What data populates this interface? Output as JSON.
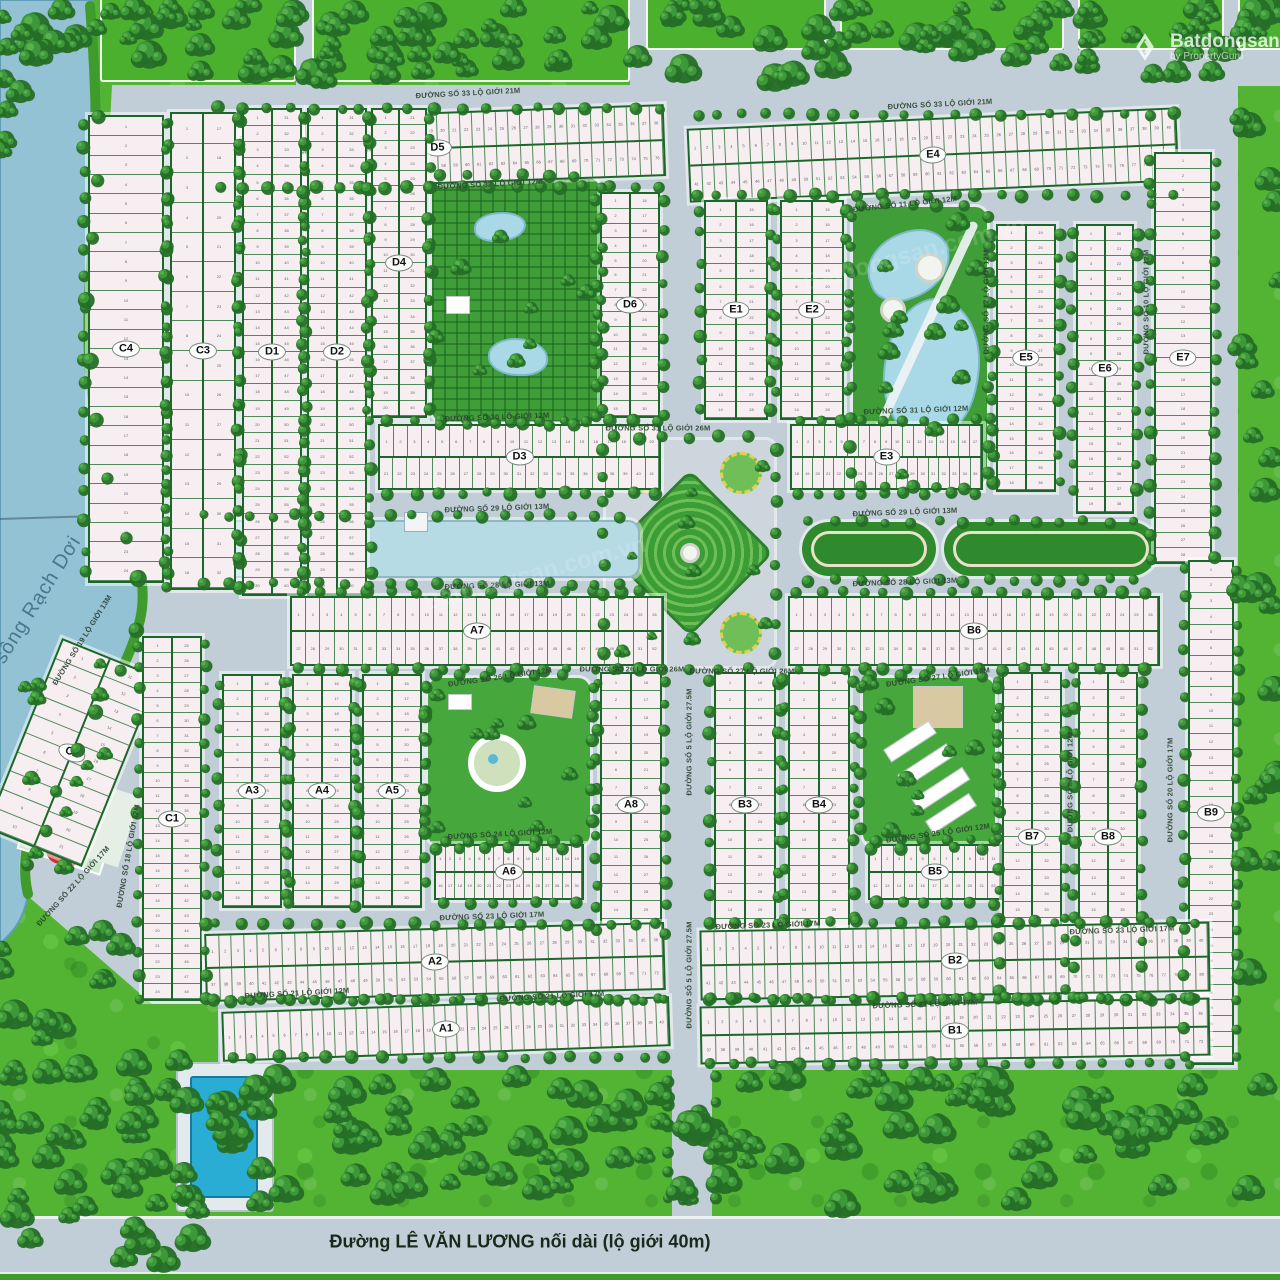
{
  "watermark": {
    "brand": "Batdongsan",
    "byline": "by PropertyGuru"
  },
  "diagonal_watermark": "Batdongsan.com.vn",
  "river": {
    "name": "sông Rạch Dơi"
  },
  "main_road": {
    "name": "Đường LÊ VĂN LƯƠNG nối dài (lộ giới 40m)"
  },
  "colors": {
    "road": "#c2ced7",
    "lot_fill": "#f7eef1",
    "block_border": "#1b672a",
    "grass": "#53b434",
    "tree": "#2c7e2e",
    "river_water": "#93c2d4",
    "pond": "#a9d9e6",
    "pool": "#29add5"
  },
  "blocks": [
    {
      "label": "D5",
      "x": 210,
      "y": 112,
      "w": 455,
      "h": 72,
      "dir": "h",
      "rows": [
        38,
        38
      ],
      "rot": -2
    },
    {
      "label": "C4",
      "x": 88,
      "y": 115,
      "w": 76,
      "h": 468,
      "dir": "v",
      "rows": [
        24
      ]
    },
    {
      "label": "C3",
      "x": 170,
      "y": 112,
      "w": 66,
      "h": 478,
      "dir": "v",
      "rows": [
        16,
        16
      ]
    },
    {
      "label": "D1",
      "x": 242,
      "y": 108,
      "w": 60,
      "h": 488,
      "dir": "v",
      "rows": [
        30,
        30
      ]
    },
    {
      "label": "D2",
      "x": 307,
      "y": 108,
      "w": 60,
      "h": 488,
      "dir": "v",
      "rows": [
        30,
        30
      ]
    },
    {
      "label": "D4",
      "x": 371,
      "y": 108,
      "w": 56,
      "h": 310,
      "dir": "v",
      "rows": [
        20,
        20
      ]
    },
    {
      "label": "D6",
      "x": 600,
      "y": 192,
      "w": 60,
      "h": 226,
      "dir": "v",
      "rows": [
        15,
        15
      ]
    },
    {
      "label": "D3",
      "x": 378,
      "y": 424,
      "w": 283,
      "h": 66,
      "dir": "h",
      "rows": [
        20,
        21
      ]
    },
    {
      "label": "E4",
      "x": 688,
      "y": 118,
      "w": 490,
      "h": 74,
      "dir": "h",
      "rows": [
        40,
        40
      ],
      "rot": -2.5
    },
    {
      "label": "E1",
      "x": 704,
      "y": 200,
      "w": 64,
      "h": 220,
      "dir": "v",
      "rows": [
        14,
        14
      ]
    },
    {
      "label": "E2",
      "x": 780,
      "y": 200,
      "w": 64,
      "h": 220,
      "dir": "v",
      "rows": [
        14,
        14
      ]
    },
    {
      "label": "E3",
      "x": 790,
      "y": 424,
      "w": 193,
      "h": 66,
      "dir": "h",
      "rows": [
        17,
        18
      ]
    },
    {
      "label": "E5",
      "x": 996,
      "y": 224,
      "w": 60,
      "h": 268,
      "dir": "v",
      "rows": [
        18,
        18
      ]
    },
    {
      "label": "E6",
      "x": 1076,
      "y": 224,
      "w": 58,
      "h": 290,
      "dir": "v",
      "rows": [
        19,
        19
      ]
    },
    {
      "label": "E7",
      "x": 1154,
      "y": 152,
      "w": 58,
      "h": 412,
      "dir": "v",
      "rows": [
        28
      ]
    },
    {
      "label": "A7",
      "x": 290,
      "y": 596,
      "w": 374,
      "h": 70,
      "dir": "h",
      "rows": [
        26,
        26
      ]
    },
    {
      "label": "B6",
      "x": 788,
      "y": 596,
      "w": 372,
      "h": 70,
      "dir": "h",
      "rows": [
        26,
        26
      ]
    },
    {
      "label": "C2",
      "x": 20,
      "y": 650,
      "w": 104,
      "h": 205,
      "dir": "v",
      "rows": [
        10,
        11
      ],
      "rot": 22
    },
    {
      "label": "C1",
      "x": 142,
      "y": 636,
      "w": 60,
      "h": 365,
      "dir": "v",
      "rows": [
        24,
        24
      ]
    },
    {
      "label": "A3",
      "x": 222,
      "y": 674,
      "w": 60,
      "h": 234,
      "dir": "v",
      "rows": [
        15,
        15
      ]
    },
    {
      "label": "A4",
      "x": 292,
      "y": 674,
      "w": 60,
      "h": 234,
      "dir": "v",
      "rows": [
        15,
        15
      ]
    },
    {
      "label": "A5",
      "x": 362,
      "y": 674,
      "w": 60,
      "h": 234,
      "dir": "v",
      "rows": [
        15,
        15
      ]
    },
    {
      "label": "A8",
      "x": 600,
      "y": 672,
      "w": 62,
      "h": 266,
      "dir": "v",
      "rows": [
        15,
        15
      ]
    },
    {
      "label": "A6",
      "x": 434,
      "y": 844,
      "w": 150,
      "h": 56,
      "dir": "h",
      "rows": [
        15,
        15
      ]
    },
    {
      "label": "B3",
      "x": 714,
      "y": 672,
      "w": 62,
      "h": 266,
      "dir": "v",
      "rows": [
        15,
        15
      ]
    },
    {
      "label": "B4",
      "x": 788,
      "y": 672,
      "w": 62,
      "h": 266,
      "dir": "v",
      "rows": [
        15,
        15
      ]
    },
    {
      "label": "B5",
      "x": 868,
      "y": 844,
      "w": 134,
      "h": 56,
      "dir": "h",
      "rows": [
        11,
        11
      ]
    },
    {
      "label": "B7",
      "x": 1002,
      "y": 672,
      "w": 60,
      "h": 330,
      "dir": "v",
      "rows": [
        20,
        20
      ]
    },
    {
      "label": "B8",
      "x": 1078,
      "y": 672,
      "w": 60,
      "h": 330,
      "dir": "v",
      "rows": [
        20,
        20
      ]
    },
    {
      "label": "B9",
      "x": 1188,
      "y": 560,
      "w": 46,
      "h": 505,
      "dir": "v",
      "rows": [
        32
      ]
    },
    {
      "label": "A2",
      "x": 205,
      "y": 928,
      "w": 460,
      "h": 68,
      "dir": "h",
      "rows": [
        36,
        36
      ],
      "rot": -1.5
    },
    {
      "label": "A1",
      "x": 222,
      "y": 1004,
      "w": 448,
      "h": 50,
      "dir": "h",
      "rows": [
        40
      ],
      "rot": -2
    },
    {
      "label": "B2",
      "x": 700,
      "y": 926,
      "w": 510,
      "h": 70,
      "dir": "h",
      "rows": [
        40,
        40
      ],
      "rot": -1
    },
    {
      "label": "B1",
      "x": 700,
      "y": 1002,
      "w": 510,
      "h": 58,
      "dir": "h",
      "rows": [
        36,
        36
      ],
      "rot": -1
    }
  ],
  "streets": [
    {
      "t": "ĐƯỜNG SỐ 33 LỘ GIỚI 21M",
      "x": 468,
      "y": 93,
      "r": -3
    },
    {
      "t": "ĐƯỜNG SỐ 33 LỘ GIỚI 21M",
      "x": 940,
      "y": 104,
      "r": -3
    },
    {
      "t": "ĐƯỜNG SỐ 32 LỘ GIỚI 12M",
      "x": 490,
      "y": 184,
      "r": -3
    },
    {
      "t": "ĐƯỜNG SỐ 30 LỘ GIỚI 12M",
      "x": 497,
      "y": 417,
      "r": -2
    },
    {
      "t": "ĐƯỜNG SỐ 31 LỘ GIỚI 26M",
      "x": 658,
      "y": 428,
      "r": 0
    },
    {
      "t": "ĐƯỜNG SỐ 31 LỘ GIỚI 12M",
      "x": 916,
      "y": 410,
      "r": -2
    },
    {
      "t": "ĐƯỜNG SỐ 11 LỘ GIỚI 12M",
      "x": 905,
      "y": 204,
      "r": -6
    },
    {
      "t": "ĐƯỜNG SỐ 29 LỘ GIỚI 13M",
      "x": 497,
      "y": 508,
      "r": -2
    },
    {
      "t": "ĐƯỜNG SỐ 29 LỘ GIỚI 13M",
      "x": 905,
      "y": 512,
      "r": -2
    },
    {
      "t": "ĐƯỜNG SỐ 28 LỘ GIỚI 13M",
      "x": 497,
      "y": 585,
      "r": -2
    },
    {
      "t": "ĐƯỜNG SỐ 28 LỘ GIỚI 13M",
      "x": 905,
      "y": 582,
      "r": -2
    },
    {
      "t": "ĐƯỜNG SỐ 26 LỘ GIỚI 12M",
      "x": 500,
      "y": 677,
      "r": -8
    },
    {
      "t": "ĐƯỜNG SỐ 26 LỘ GIỚI 26M",
      "x": 632,
      "y": 669,
      "r": 0
    },
    {
      "t": "ĐƯỜNG SỐ 27 LỘ GIỚI 26M",
      "x": 742,
      "y": 671,
      "r": 0
    },
    {
      "t": "ĐƯỜNG SỐ 27 LỘ GIỚI 12M",
      "x": 938,
      "y": 677,
      "r": -8
    },
    {
      "t": "ĐƯỜNG SỐ 24 LỘ GIỚI 12M",
      "x": 500,
      "y": 834,
      "r": -3
    },
    {
      "t": "ĐƯỜNG SỐ 25 LỘ GIỚI 12M",
      "x": 938,
      "y": 833,
      "r": -8
    },
    {
      "t": "ĐƯỜNG SỐ 23 LỘ GIỚI 17M",
      "x": 492,
      "y": 916,
      "r": -2
    },
    {
      "t": "ĐƯỜNG SỐ 23 LỘ GIỚI 17M",
      "x": 768,
      "y": 925,
      "r": -2
    },
    {
      "t": "ĐƯỜNG SỐ 23 LỘ GIỚI 17M",
      "x": 1122,
      "y": 930,
      "r": -2
    },
    {
      "t": "ĐƯỜNG SỐ 21 LỘ GIỚI 12M",
      "x": 297,
      "y": 993,
      "r": -3
    },
    {
      "t": "ĐƯỜNG SỐ 21 LỘ GIỚI 17M",
      "x": 552,
      "y": 996,
      "r": -3
    },
    {
      "t": "ĐƯỜNG SỐ 21 LỘ GIỚI 17M",
      "x": 925,
      "y": 1004,
      "r": -2
    },
    {
      "t": "ĐƯỜNG SỐ 5 LỘ GIỚI 27.5M",
      "x": 689,
      "y": 742,
      "r": -90
    },
    {
      "t": "ĐƯỜNG SỐ 5 LỘ GIỚI 27.5M",
      "x": 689,
      "y": 975,
      "r": -90
    },
    {
      "t": "ĐƯỜNG SỐ 12 LỘ GIỚI 12M",
      "x": 986,
      "y": 302,
      "r": -90
    },
    {
      "t": "ĐƯỜNG SỐ 10 LỘ GIỚI 12M",
      "x": 1146,
      "y": 302,
      "r": -90
    },
    {
      "t": "ĐƯỜNG SỐ 8 LỘ GIỚI 12M",
      "x": 1070,
      "y": 782,
      "r": -90
    },
    {
      "t": "ĐƯỜNG SỐ 20 LỘ GIỚI 17M",
      "x": 1170,
      "y": 790,
      "r": -90
    },
    {
      "t": "ĐƯỜNG SỐ 18 LỘ GIỚI 12M",
      "x": 128,
      "y": 856,
      "r": -80
    },
    {
      "t": "ĐƯỜNG SỐ 22 LỘ GIỚI 17M",
      "x": 73,
      "y": 886,
      "r": -48
    },
    {
      "t": "ĐƯỜNG SỐ 19 LỘ GIỚI 13M",
      "x": 82,
      "y": 640,
      "r": -58
    }
  ]
}
